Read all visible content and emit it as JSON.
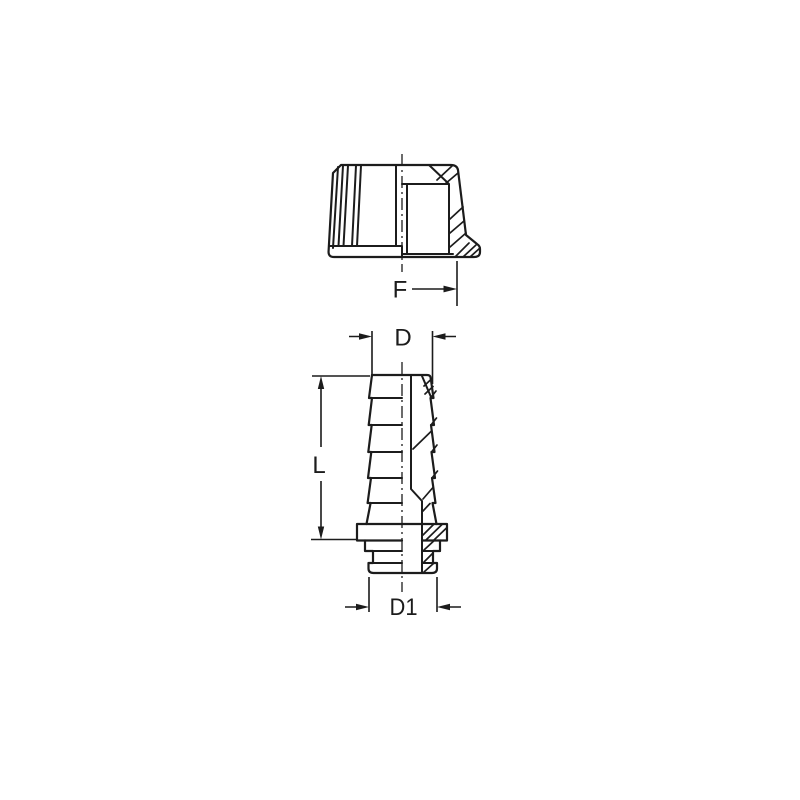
{
  "drawing": {
    "background_color": "#ffffff",
    "line_color": "#1c1c1c",
    "views": [
      {
        "name": "cap-half-section-side-view"
      },
      {
        "name": "hose-barb-half-section-side-view"
      }
    ],
    "dimensions": {
      "f": "F",
      "d": "D",
      "l": "L",
      "d1": "D1"
    }
  }
}
